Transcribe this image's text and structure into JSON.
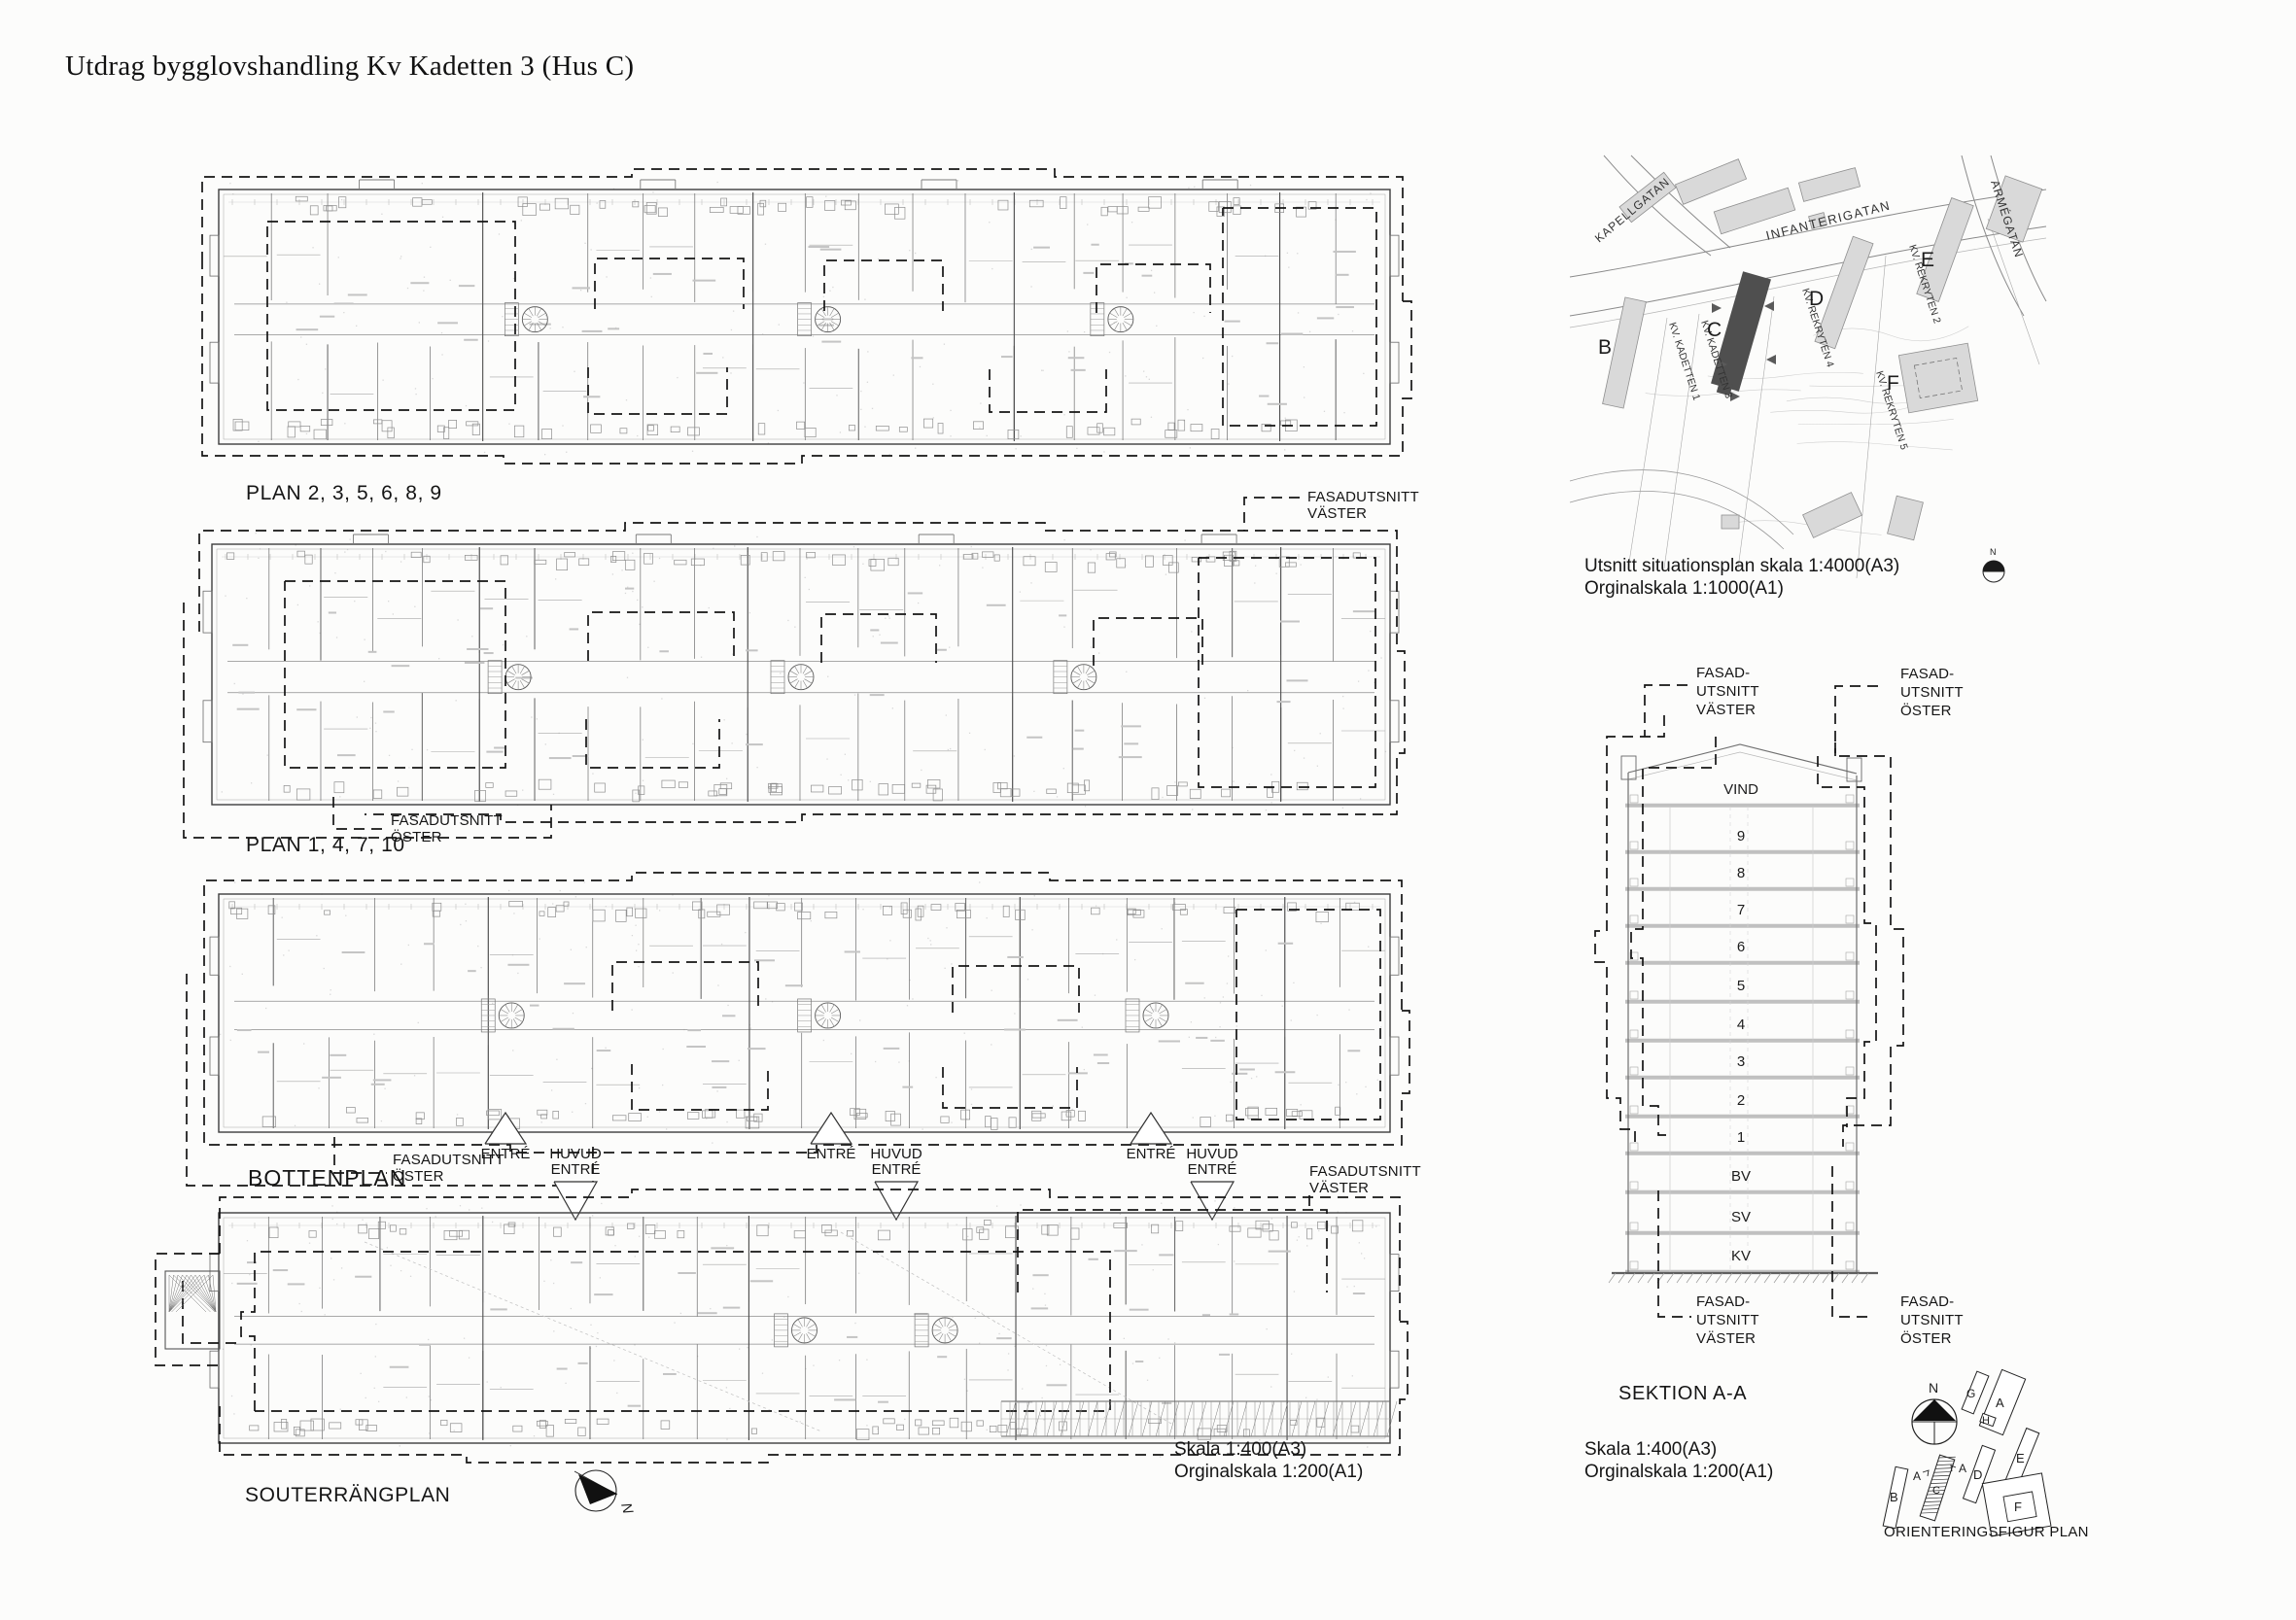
{
  "title": "Utdrag bygglovshandling Kv Kadetten 3 (Hus C)",
  "plan_labels": {
    "upper": "PLAN 2, 3, 5, 6, 8, 9",
    "lower": "PLAN 1, 4, 7, 10",
    "ground": "BOTTENPLAN",
    "basement": "SOUTERRÄNGPLAN"
  },
  "facade_labels": {
    "fasadutsnitt_vaster": "FASADUTSNITT\nVÄSTER",
    "fasadutsnitt_oster": "FASADUTSNITT\nÖSTER",
    "fasad_utsnitt_vaster": "FASAD-\nUTSNITT\nVÄSTER",
    "fasad_utsnitt_oster": "FASAD-\nUTSNITT\nÖSTER"
  },
  "entrance_labels": {
    "entre": "ENTRÉ",
    "huvud_entre": "HUVUD\nENTRÉ"
  },
  "situation_plan": {
    "streets": [
      "KAPELLGATAN",
      "INFANTERIGATAN",
      "ARMÉGATAN"
    ],
    "blocks": [
      "KV. KADETTEN 1",
      "KV. KADETTEN 3",
      "KV. REKRYTEN 4",
      "KV. REKRYTEN 2",
      "KV. REKRYTEN 5"
    ],
    "building_letters": [
      "B",
      "C",
      "D",
      "E",
      "F"
    ],
    "caption": "Utsnitt situationsplan skala 1:4000(A3)\nOrginalskala 1:1000(A1)",
    "north": "N"
  },
  "section": {
    "title": "SEKTION A-A",
    "floors": [
      "VIND",
      "9",
      "8",
      "7",
      "6",
      "5",
      "4",
      "3",
      "2",
      "1",
      "BV",
      "SV",
      "KV"
    ],
    "scale": "Skala 1:400(A3)\nOrginalskala 1:200(A1)"
  },
  "floorplan_scale": "Skala 1:400(A3)\nOrginalskala 1:200(A1)",
  "orientation_figure": {
    "label": "ORIENTERINGSFIGUR PLAN",
    "buildings": [
      "G",
      "A",
      "H",
      "E",
      "D",
      "B",
      "C",
      "F"
    ],
    "section_mark": "A",
    "north": "N"
  }
}
